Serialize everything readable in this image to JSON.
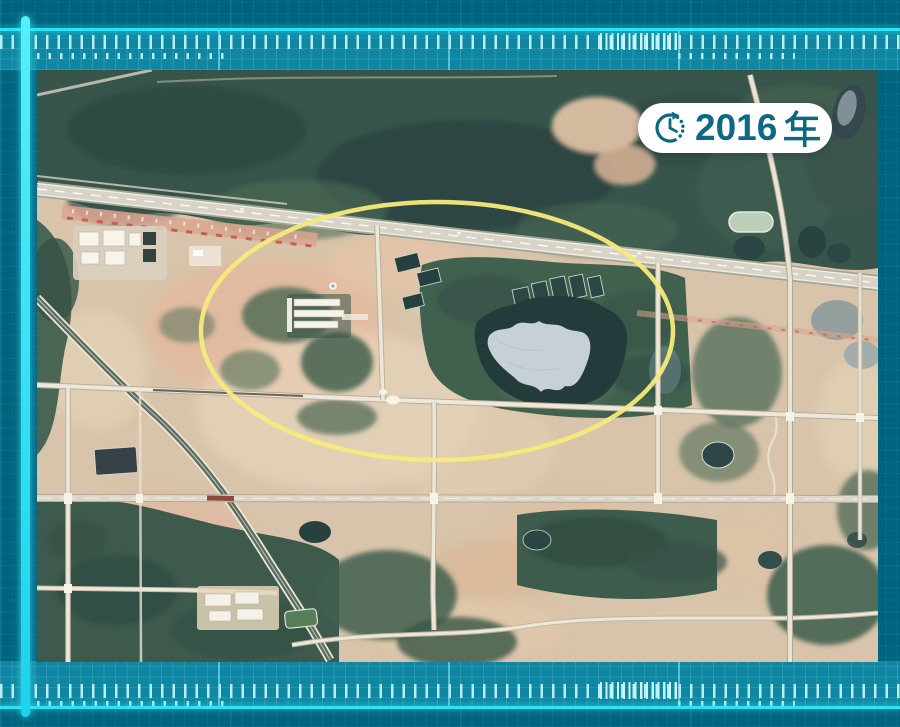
{
  "year_badge": {
    "label": "2016年",
    "digits": "2016",
    "suffix_character": "年",
    "icon": "clock-history-icon",
    "text_color": "#0E6A84",
    "background_color": "#FFFFFF"
  },
  "annotation": {
    "shape": "ellipse",
    "stroke_color": "#F6EA7C"
  },
  "frame": {
    "outer_color": "#00647E",
    "band_color": "#0F87A2",
    "accent_color": "#2FE3F5"
  },
  "map": {
    "kind": "satellite-imagery"
  }
}
